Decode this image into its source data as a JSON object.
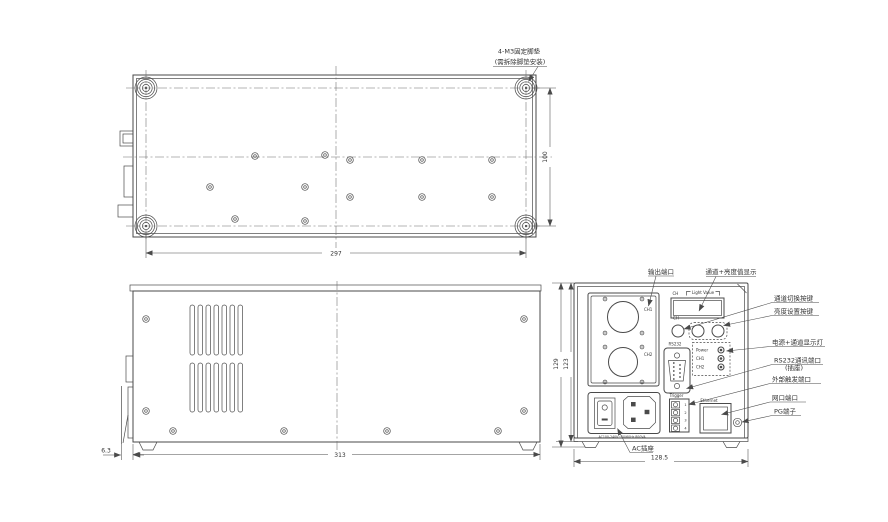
{
  "colors": {
    "line": "#4a4a4a",
    "text": "#333333",
    "background": "#ffffff"
  },
  "bottom_view": {
    "callout_line1": "4-M3固定脚垫",
    "callout_line2": "(需拆除脚垫安装)",
    "dim_width": "297",
    "dim_depth": "100"
  },
  "side_view": {
    "dim_width": "313",
    "dim_foot": "6.3"
  },
  "rear_view": {
    "dim_width": "128.5",
    "dim_height_outer": "129",
    "dim_height_inner": "123",
    "panel": {
      "display_ch": "CH",
      "display_value": "Light Value",
      "ch1": "CH1",
      "ch2": "CH2",
      "btn_ch": "CH",
      "rs232": "RS232",
      "led_power": "Power",
      "led_ch1": "CH1",
      "led_ch2": "CH2",
      "trigger": "Trigger",
      "trigger_pins": [
        "1",
        "2",
        "3",
        "4"
      ],
      "ethernet": "Ethernet",
      "ac_rating": "AC100-240V~50/60Hz 800VA"
    },
    "callouts": {
      "output_port": "输出端口",
      "display": "通道+亮度值显示",
      "channel_switch": "通道切换按键",
      "brightness_set": "亮度设置按键",
      "power_leds": "电源+通道显示灯",
      "rs232_line1": "RS232通讯端口",
      "rs232_line2": "(插座)",
      "ext_trigger": "外部触发端口",
      "lan": "网口端口",
      "pg": "PG端子",
      "ac_socket": "AC插座"
    }
  }
}
